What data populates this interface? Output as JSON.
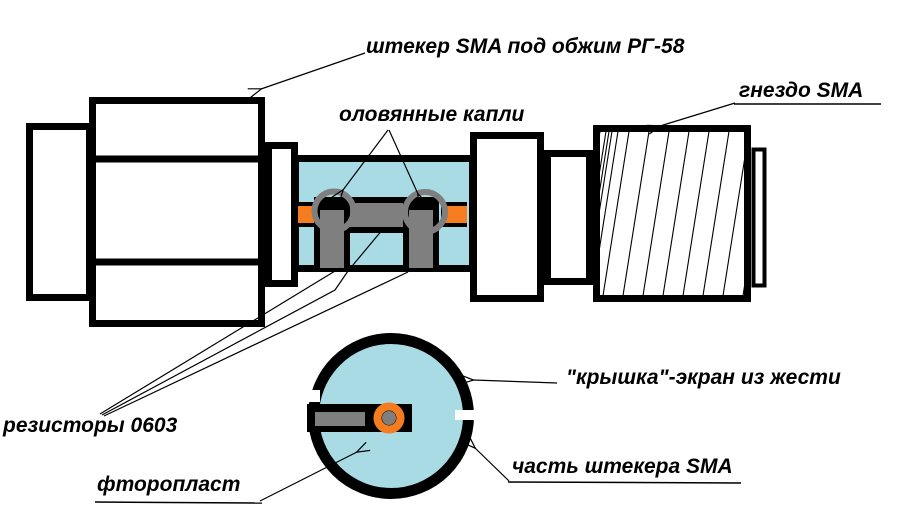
{
  "diagram": {
    "labels": {
      "plug": "штекер SMA под обжим РГ-58",
      "tin_drops": "оловянные капли",
      "socket": "гнездо SMA",
      "resistors": "резисторы 0603",
      "ptfe": "фторопласт",
      "cover": "\"крышка\"-экран из жести",
      "plug_part": "часть штекера SMA"
    },
    "colors": {
      "dielectric_blue": "#A9DBE4",
      "conductor_orange": "#F57C1F",
      "solder_gray": "#7F7F7F",
      "outline_black": "#000000",
      "background": "#FFFFFF"
    }
  }
}
